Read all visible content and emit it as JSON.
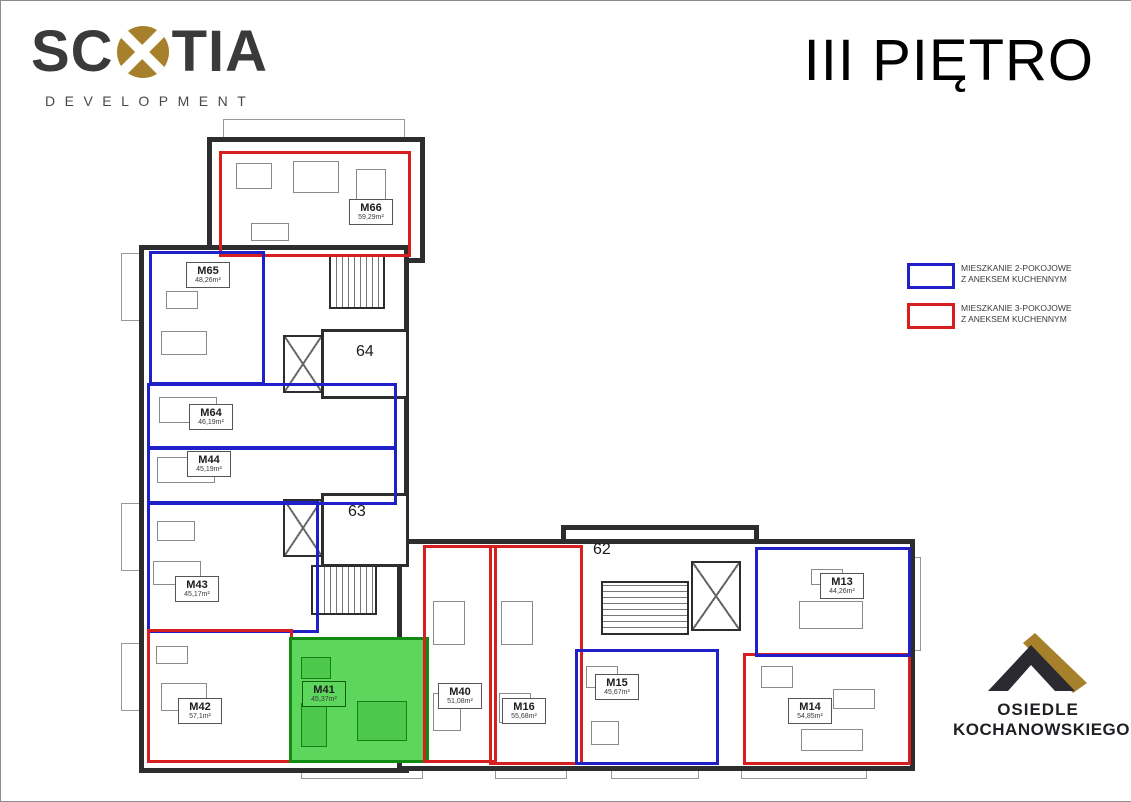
{
  "header": {
    "brand_left": "SC",
    "brand_right": "TIA",
    "brand_sub": "DEVELOPMENT",
    "title": "III PIĘTRO"
  },
  "legend": {
    "two_room": {
      "line1": "MIESZKANIE 2-POKOJOWE",
      "line2": "Z ANEKSEM KUCHENNYM"
    },
    "three_room": {
      "line1": "MIESZKANIE 3-POKOJOWE",
      "line2": "Z ANEKSEM KUCHENNYM"
    }
  },
  "estate_logo": {
    "line1": "OSIEDLE",
    "line2": "KOCHANOWSKIEGO"
  },
  "floorplan": {
    "stairwells": {
      "s62": "62",
      "s63": "63",
      "s64": "64"
    },
    "highlighted_unit": "M41",
    "units": {
      "M66": {
        "label": "M66",
        "area": "59,29m²",
        "type": "3-pokojowe"
      },
      "M65": {
        "label": "M65",
        "area": "48,26m²",
        "type": "2-pokojowe"
      },
      "M64": {
        "label": "M64",
        "area": "46,19m²",
        "type": "2-pokojowe"
      },
      "M44": {
        "label": "M44",
        "area": "45,19m²",
        "type": "2-pokojowe"
      },
      "M43": {
        "label": "M43",
        "area": "45,17m²",
        "type": "2-pokojowe"
      },
      "M42": {
        "label": "M42",
        "area": "57,1m²",
        "type": "3-pokojowe"
      },
      "M41": {
        "label": "M41",
        "area": "45,37m²",
        "type": "highlighted"
      },
      "M40": {
        "label": "M40",
        "area": "51,08m²",
        "type": "3-pokojowe"
      },
      "M16": {
        "label": "M16",
        "area": "55,68m²",
        "type": "3-pokojowe"
      },
      "M15": {
        "label": "M15",
        "area": "45,67m²",
        "type": "2-pokojowe"
      },
      "M14": {
        "label": "M14",
        "area": "54,85m²",
        "type": "3-pokojowe"
      },
      "M13": {
        "label": "M13",
        "area": "44,26m²",
        "type": "2-pokojowe"
      }
    },
    "colors": {
      "two_room": "#2020c8",
      "three_room": "#d81f1f",
      "highlight_fill": "#5cd65c",
      "highlight_border": "#128a12",
      "wall": "#2d2d30"
    }
  }
}
